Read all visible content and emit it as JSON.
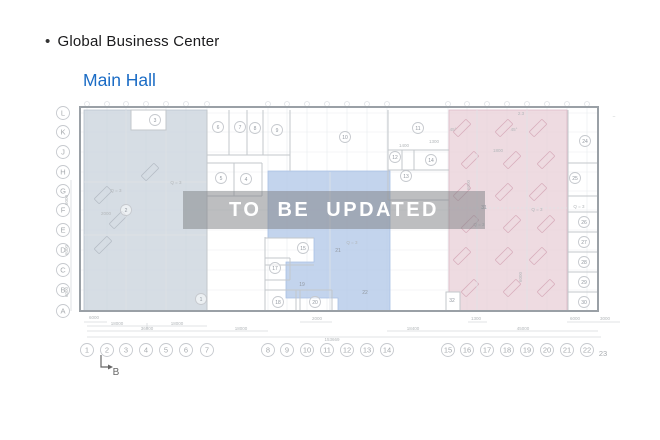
{
  "header": {
    "bullet": "•",
    "title": "Global Business Center",
    "subtitle": "Main Hall",
    "subtitle_color": "#1b6cc5"
  },
  "watermark": {
    "text": "TO BE UPDATED"
  },
  "plan": {
    "colors": {
      "wall": "#9aa0a6",
      "partition": "#c3c7cb",
      "faint": "#dfe2e6",
      "grid": "#eceff1",
      "dim_line": "#d7dadd",
      "dim_text": "#b3b7ba",
      "room_text": "#9298a0",
      "axis_text": "#a6aaae",
      "circle": "#c6c9ce",
      "zone_left": "#ccd4dd",
      "zone_mid": "#b4c9e8",
      "zone_pink": "#ead2da",
      "zone_left_edge": "#b9c2cd",
      "zone_mid_edge": "#a9c0e4",
      "zone_pink_edge": "#ddb9c6",
      "desk_pink": "#d8aebc",
      "desk_left": "#b6bdc6",
      "watermark_bg": "rgba(128,131,134,0.52)",
      "marker": "#666666"
    },
    "row_axis": [
      {
        "t": "L",
        "y": 113
      },
      {
        "t": "K",
        "y": 132
      },
      {
        "t": "J",
        "y": 152
      },
      {
        "t": "H",
        "y": 172
      },
      {
        "t": "G",
        "y": 191
      },
      {
        "t": "F",
        "y": 210
      },
      {
        "t": "E",
        "y": 230
      },
      {
        "t": "D",
        "y": 250
      },
      {
        "t": "C",
        "y": 270
      },
      {
        "t": "B",
        "y": 290
      },
      {
        "t": "A",
        "y": 311
      }
    ],
    "col_axis": [
      {
        "t": "1",
        "x": 87
      },
      {
        "t": "2",
        "x": 107
      },
      {
        "t": "3",
        "x": 126
      },
      {
        "t": "4",
        "x": 146
      },
      {
        "t": "5",
        "x": 166
      },
      {
        "t": "6",
        "x": 186
      },
      {
        "t": "7",
        "x": 207
      },
      {
        "t": "8",
        "x": 268
      },
      {
        "t": "9",
        "x": 287
      },
      {
        "t": "10",
        "x": 307
      },
      {
        "t": "11",
        "x": 327
      },
      {
        "t": "12",
        "x": 347
      },
      {
        "t": "13",
        "x": 367
      },
      {
        "t": "14",
        "x": 387
      },
      {
        "t": "15",
        "x": 448
      },
      {
        "t": "16",
        "x": 467
      },
      {
        "t": "17",
        "x": 487
      },
      {
        "t": "18",
        "x": 507
      },
      {
        "t": "19",
        "x": 527
      },
      {
        "t": "20",
        "x": 547
      },
      {
        "t": "21",
        "x": 567
      },
      {
        "t": "22",
        "x": 587
      },
      {
        "t": "23",
        "x": 603,
        "plain": true,
        "y": 356
      }
    ],
    "rooms": [
      {
        "n": "1",
        "x": 201,
        "y": 299
      },
      {
        "n": "2",
        "x": 126,
        "y": 210
      },
      {
        "n": "3",
        "x": 155,
        "y": 120
      },
      {
        "n": "4",
        "x": 246,
        "y": 179
      },
      {
        "n": "5",
        "x": 221,
        "y": 178
      },
      {
        "n": "6",
        "x": 218,
        "y": 127
      },
      {
        "n": "7",
        "x": 240,
        "y": 127
      },
      {
        "n": "8",
        "x": 255,
        "y": 128
      },
      {
        "n": "9",
        "x": 277,
        "y": 130
      },
      {
        "n": "10",
        "x": 345,
        "y": 137
      },
      {
        "n": "11",
        "x": 418,
        "y": 128
      },
      {
        "n": "12",
        "x": 395,
        "y": 157
      },
      {
        "n": "13",
        "x": 406,
        "y": 176
      },
      {
        "n": "14",
        "x": 431,
        "y": 160
      },
      {
        "n": "15",
        "x": 303,
        "y": 248
      },
      {
        "n": "17",
        "x": 275,
        "y": 268
      },
      {
        "n": "18",
        "x": 278,
        "y": 302
      },
      {
        "n": "19",
        "x": 302,
        "y": 284,
        "plain": true
      },
      {
        "n": "20",
        "x": 315,
        "y": 302
      },
      {
        "n": "21",
        "x": 338,
        "y": 250,
        "plain": true
      },
      {
        "n": "22",
        "x": 365,
        "y": 292,
        "plain": true
      },
      {
        "n": "24",
        "x": 585,
        "y": 141
      },
      {
        "n": "25",
        "x": 575,
        "y": 178
      },
      {
        "n": "26",
        "x": 584,
        "y": 222
      },
      {
        "n": "27",
        "x": 584,
        "y": 242
      },
      {
        "n": "28",
        "x": 584,
        "y": 262
      },
      {
        "n": "29",
        "x": 584,
        "y": 282
      },
      {
        "n": "30",
        "x": 584,
        "y": 302
      },
      {
        "n": "31",
        "x": 484,
        "y": 207,
        "plain": true
      },
      {
        "n": "32",
        "x": 452,
        "y": 300,
        "plain": true
      }
    ],
    "labels": [
      {
        "t": "Q = 3",
        "x": 176,
        "y": 184
      },
      {
        "t": "Q = 3",
        "x": 116,
        "y": 192
      },
      {
        "t": "Q = 3",
        "x": 352,
        "y": 244
      },
      {
        "t": "Q = 3",
        "x": 537,
        "y": 211
      },
      {
        "t": "Q = 3",
        "x": 479,
        "y": 226
      },
      {
        "t": "Q = 3",
        "x": 579,
        "y": 208
      },
      {
        "t": "2000",
        "x": 106,
        "y": 215
      },
      {
        "t": "2.3",
        "x": 521,
        "y": 115
      },
      {
        "t": "1800",
        "x": 498,
        "y": 152
      },
      {
        "t": "1400",
        "x": 404,
        "y": 147
      },
      {
        "t": "1300",
        "x": 434,
        "y": 143
      },
      {
        "t": "45°",
        "x": 453,
        "y": 131
      },
      {
        "t": "45°",
        "x": 514,
        "y": 131
      },
      {
        "t": "–",
        "x": 614,
        "y": 118
      },
      {
        "t": "6000",
        "x": 68,
        "y": 200,
        "rot": -90
      },
      {
        "t": "6000",
        "x": 68,
        "y": 250,
        "rot": -90
      },
      {
        "t": "6000",
        "x": 68,
        "y": 292,
        "rot": -90
      },
      {
        "t": "6000",
        "x": 470,
        "y": 185,
        "rot": -90
      },
      {
        "t": "6000",
        "x": 522,
        "y": 277,
        "rot": -90
      },
      {
        "t": "6000",
        "x": 94,
        "y": 319
      },
      {
        "t": "2000",
        "x": 317,
        "y": 320
      },
      {
        "t": "1300",
        "x": 476,
        "y": 320
      },
      {
        "t": "6000",
        "x": 575,
        "y": 320
      },
      {
        "t": "3000",
        "x": 605,
        "y": 320
      },
      {
        "t": "18000",
        "x": 117,
        "y": 325
      },
      {
        "t": "18000",
        "x": 177,
        "y": 325
      },
      {
        "t": "36000",
        "x": 147,
        "y": 330
      },
      {
        "t": "18000",
        "x": 241,
        "y": 330
      },
      {
        "t": "18400",
        "x": 413,
        "y": 330
      },
      {
        "t": "45000",
        "x": 523,
        "y": 330
      },
      {
        "t": "153669",
        "x": 332,
        "y": 341
      }
    ],
    "section_marker": {
      "t": "B",
      "x": 112,
      "y": 375
    }
  }
}
